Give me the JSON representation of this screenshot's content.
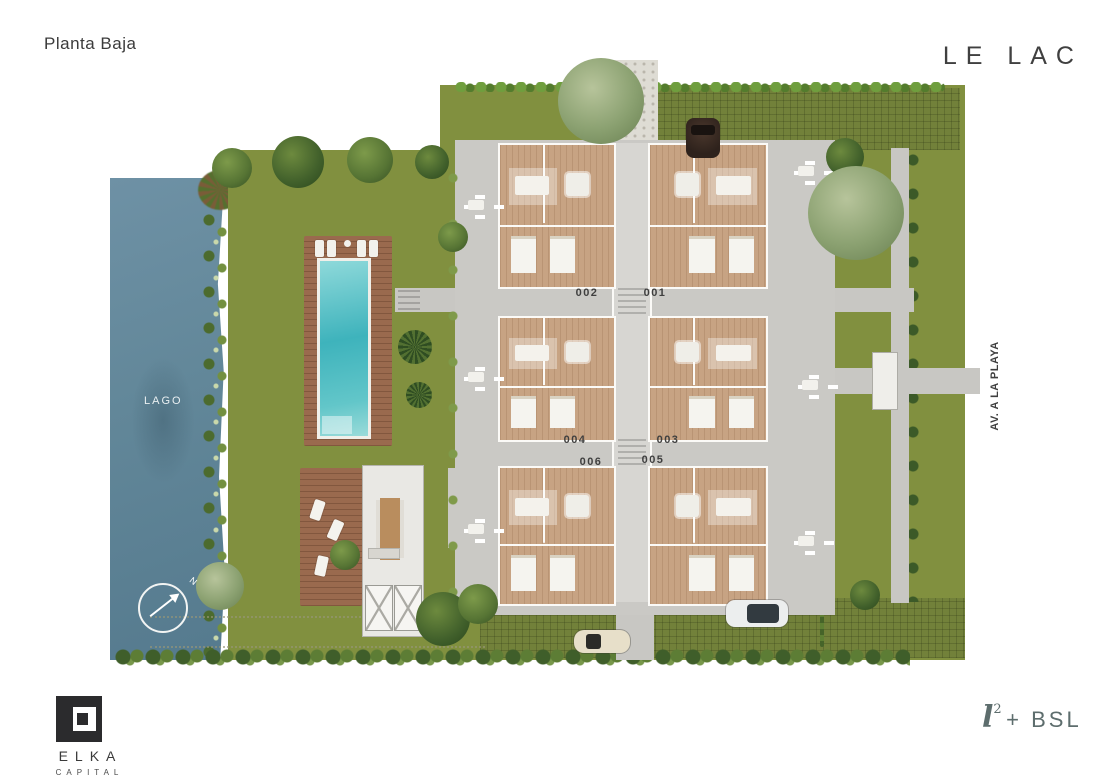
{
  "header": {
    "title": "Planta Baja",
    "brand": "LE LAC"
  },
  "plan": {
    "lake_label": "LAGO",
    "street_label": "AV. A LA PLAYA",
    "compass_label": "N",
    "units": [
      {
        "label": "001"
      },
      {
        "label": "002"
      },
      {
        "label": "003"
      },
      {
        "label": "004"
      },
      {
        "label": "005"
      },
      {
        "label": "006"
      }
    ]
  },
  "footer": {
    "logo_name": "ELKA",
    "logo_subtitle": "CAPITAL",
    "mark_l": "l",
    "mark_sup": "2",
    "mark_rest": "+ BSL"
  },
  "palette": {
    "ink": "#3b3b3b",
    "brand_ink": "#404040",
    "muted_ink": "#5d6d6d",
    "grass": "#81903f",
    "grass_paver": "#72813a",
    "lake_top": "#6e91a5",
    "lake_bottom": "#557a8e",
    "deck": "#9a6a4e",
    "pool": "#45bcc2",
    "terrace": "#cac9c5",
    "path": "#c8c7c3",
    "gravel": "#dedcd4",
    "floor": "#c7a383",
    "wall": "#fbfaf7",
    "hedge": "#49672e",
    "tree_dark": "#41602b",
    "tree_light": "#8ba171",
    "label_white": "#e9eff1"
  }
}
